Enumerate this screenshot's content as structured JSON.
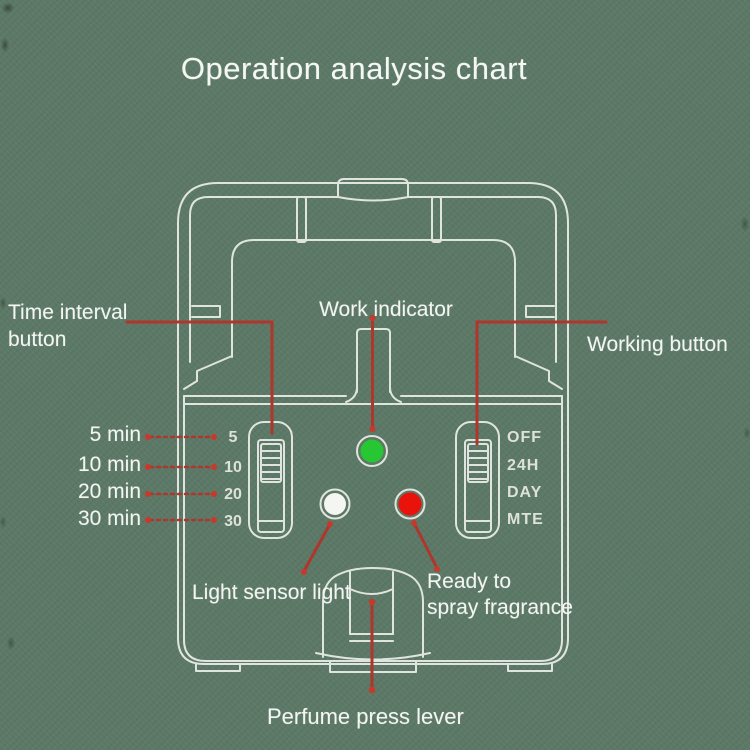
{
  "title": "Operation analysis chart",
  "colors": {
    "background": "#5c7866",
    "outline": "#e7ebe5",
    "connector": "#ae362c",
    "connector_dot": "#c8392b",
    "work_led": "#27c733",
    "sensor_led": "#f4f6f2",
    "spray_led": "#ea130c"
  },
  "labels": {
    "time_interval_button": "Time interval button",
    "work_indicator": "Work indicator",
    "working_button": "Working button",
    "light_sensor": "Light sensor light",
    "ready_to_spray_line1": "Ready to",
    "ready_to_spray_line2": "spray fragrance",
    "perfume_press_lever": "Perfume press lever"
  },
  "time_interval": {
    "options": [
      {
        "label": "5 min",
        "mark": "5"
      },
      {
        "label": "10 min",
        "mark": "10"
      },
      {
        "label": "20 min",
        "mark": "20"
      },
      {
        "label": "30 min",
        "mark": "30"
      }
    ]
  },
  "working_modes": [
    "OFF",
    "24H",
    "DAY",
    "MTE"
  ]
}
